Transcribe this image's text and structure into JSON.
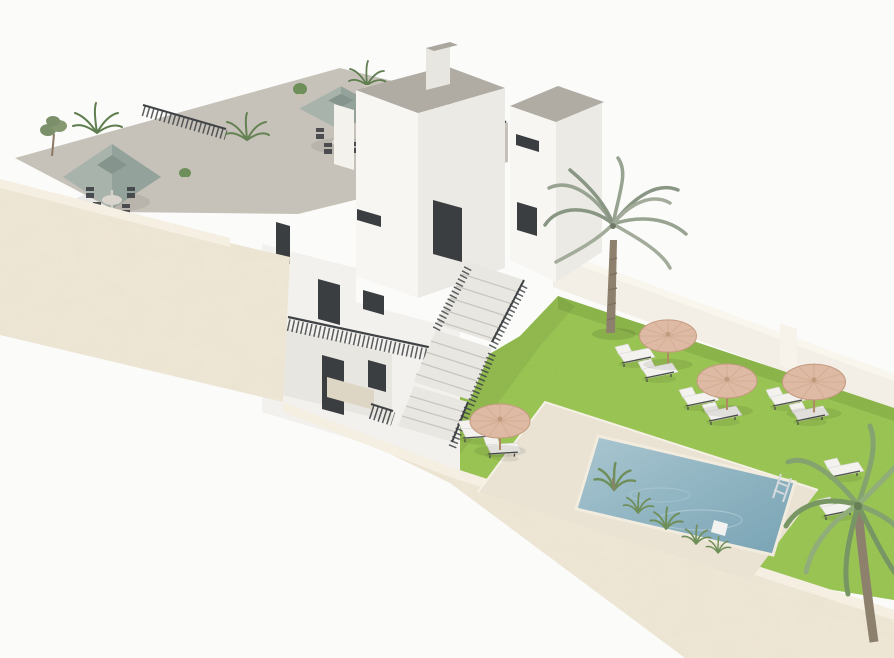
{
  "title": "Aerial 3D architectural render of a white Mediterranean apartment complex with walled pool garden",
  "render": {
    "style": "isometric aerial 3D visualization",
    "background": "plain white studio backdrop"
  },
  "building": {
    "label": "white two-storey apartment block with roof terraces",
    "towers": 2,
    "roof_canopies": 2,
    "canopy_style": "sage green square parasol",
    "terrace_dining_sets": 2,
    "terrace_chairs": 8,
    "terrace_plants": 7,
    "stair_flights": 3,
    "features": "dark framed windows and doors, dark metal railings, exterior switchback staircase, cream stone perimeter walls"
  },
  "garden": {
    "label": "walled garden with lawn and pool",
    "lawn": "bright green lawn",
    "pool": {
      "label": "rectangular swimming pool",
      "deck": "cream stone deck",
      "ladder": 1,
      "float": 1,
      "edge_plants": 5
    },
    "umbrellas": 4,
    "umbrella_style": "round straw parasol",
    "sun_loungers": 10,
    "palm_trees": 2
  },
  "colors": {
    "background": "#fbfbfa",
    "wall_stone": "#ece4d2",
    "wall_stone_light": "#f5efe2",
    "north_wall": "#f3efe6",
    "north_wall_cap": "#f9f6ee",
    "facade_white": "#f2f1ed",
    "facade_bright": "#f7f6f3",
    "facade_shaded": "#eceae4",
    "roof_gray": "#b0aca3",
    "terrace_floor": "#c6c2b9",
    "window_dark": "#3b3e41",
    "railing_dark": "#404346",
    "canopy_sage": "#93a29a",
    "canopy_sage_dark": "#85958d",
    "canopy_sage_light": "#a7b3ab",
    "lawn": "#96c24f",
    "lawn_shadow": "#7fa843",
    "pool_deck": "#eae3d3",
    "water_light": "#a9c6d0",
    "water_deep": "#78a3b4",
    "umbrella_tan": "#debaa4",
    "umbrella_tan_dark": "#c49a7f",
    "lounger_white": "#f3f2ef",
    "frame_dark": "#4a4d4b",
    "palm_frond": "#99a391",
    "corner_palm": "#85a36e",
    "plant_green": "#6f8f5a",
    "trunk_brown": "#8d816d",
    "stair_concrete": "#e9e7e2",
    "pole_wood": "#b08a64",
    "ladder_metal": "#d5dadd",
    "table_light": "#d9d5cc"
  }
}
